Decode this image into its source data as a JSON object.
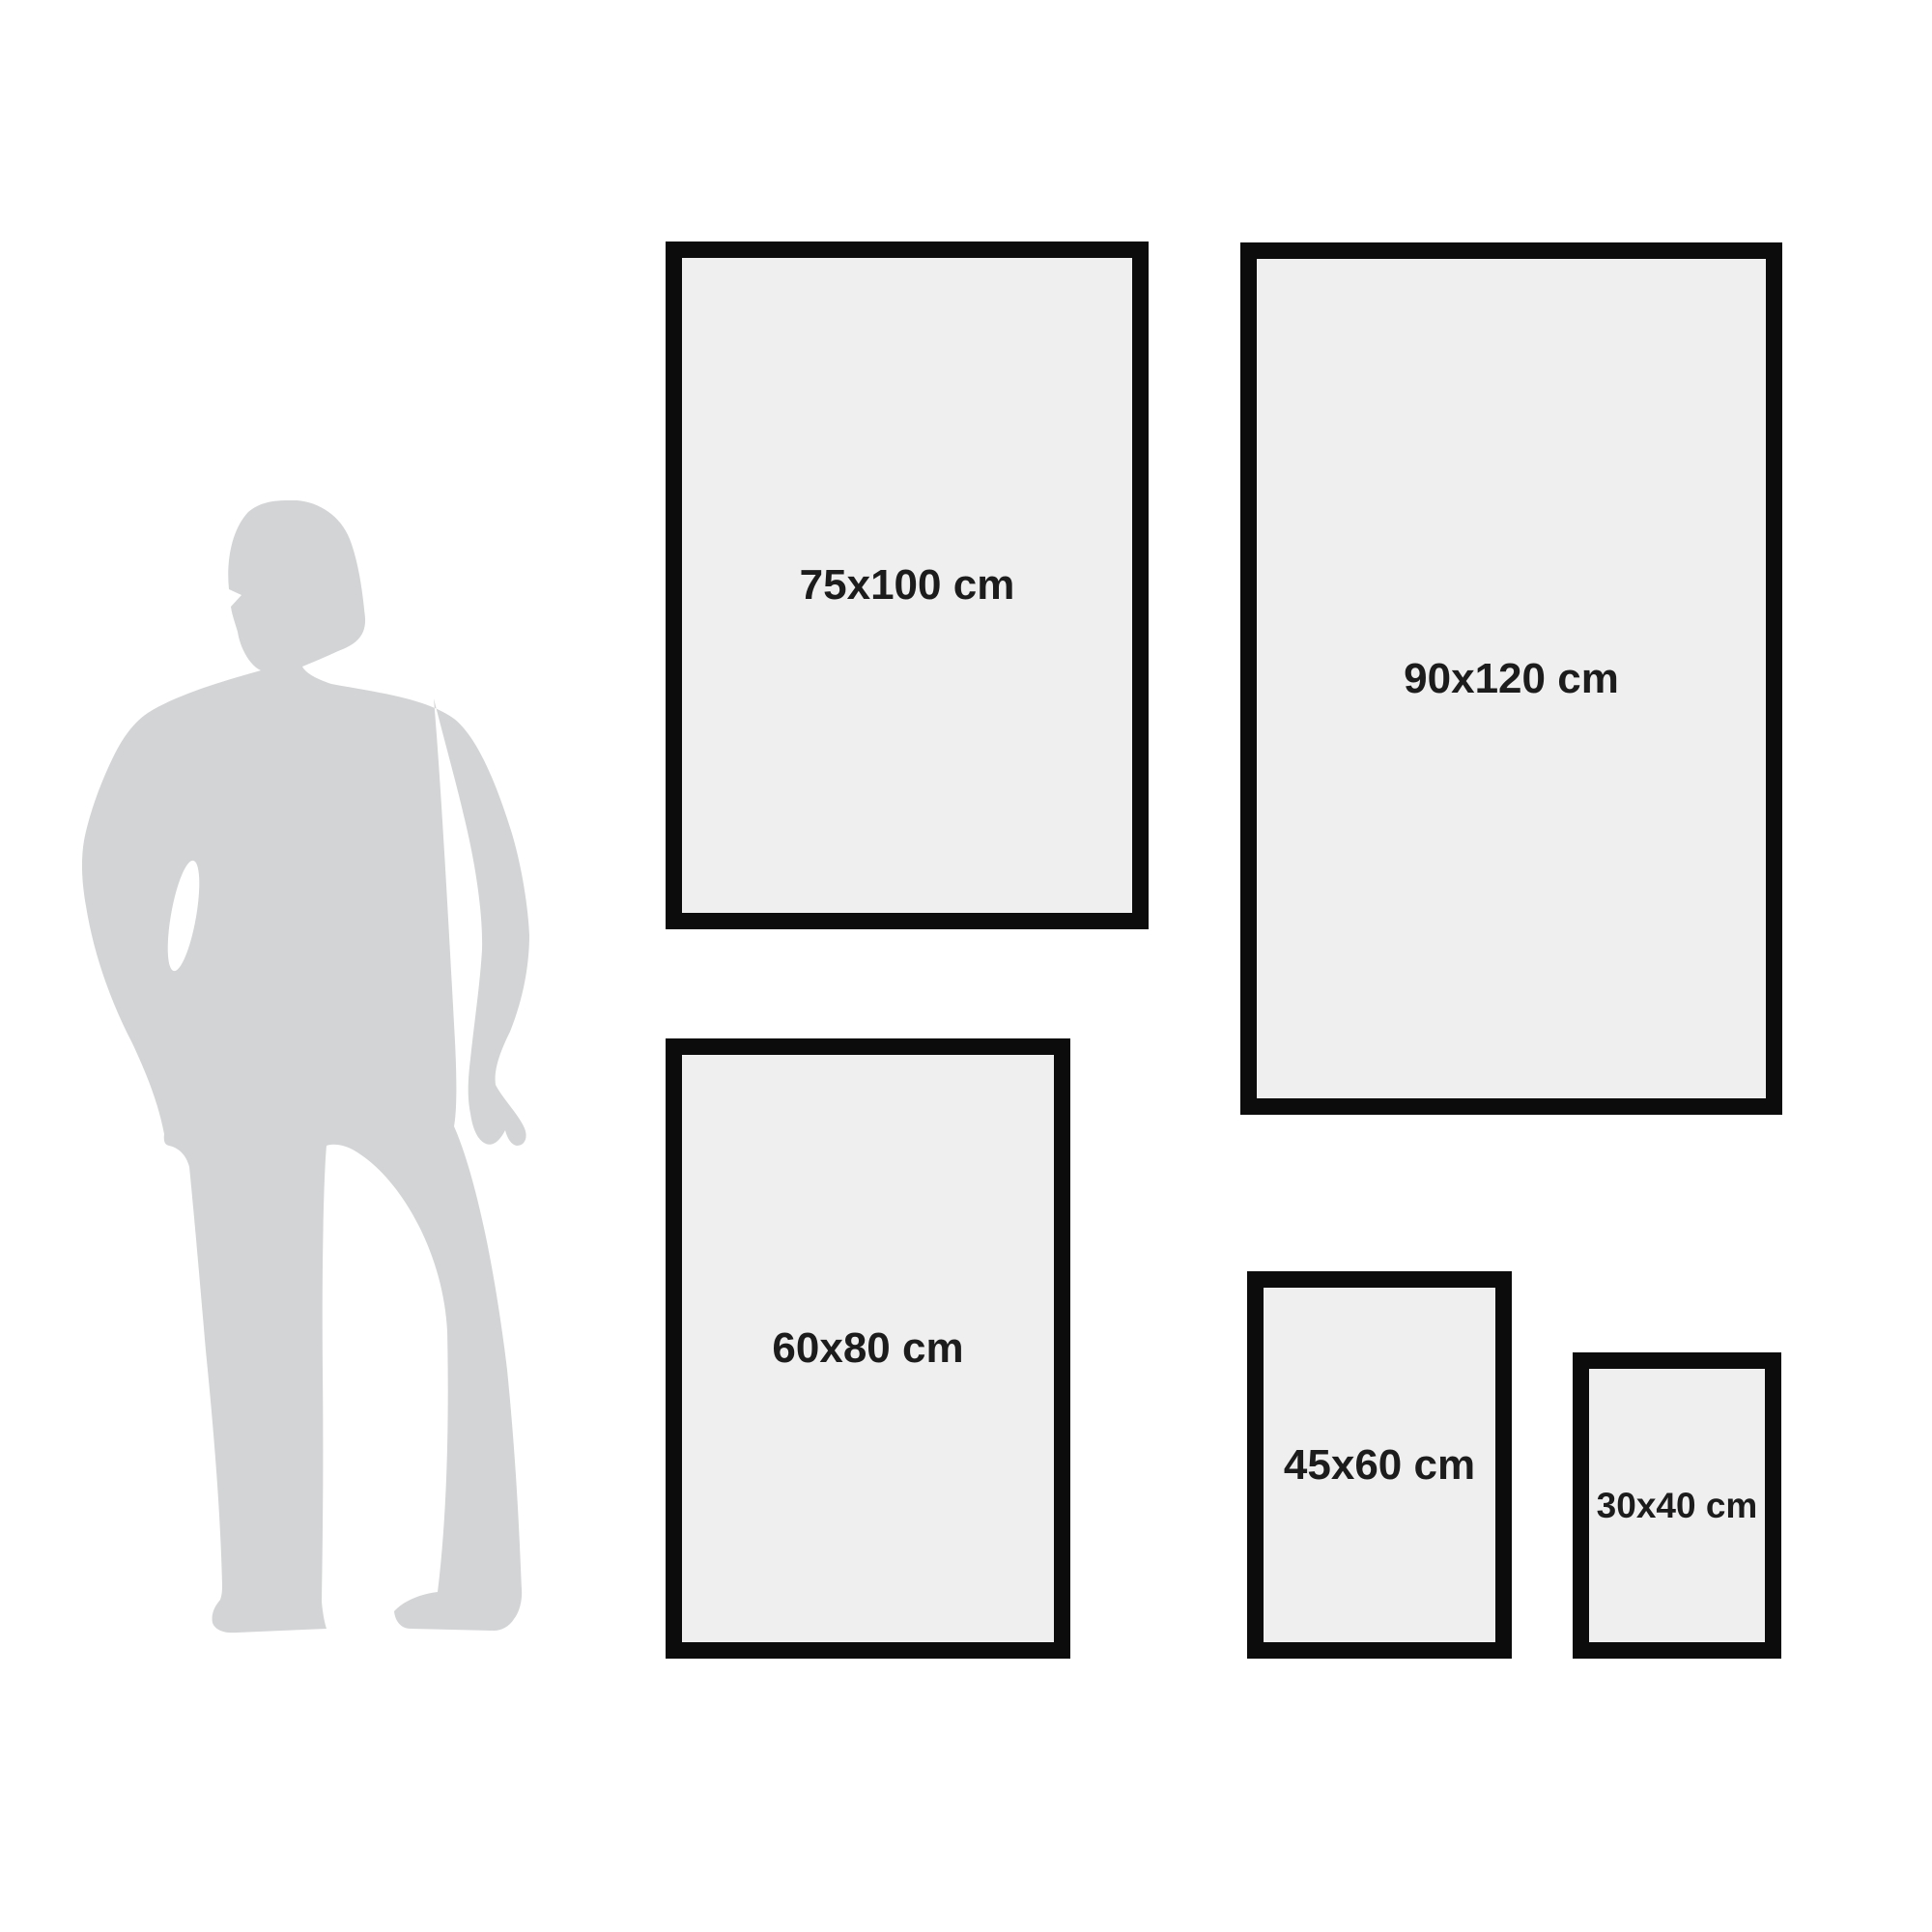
{
  "colors": {
    "background": "#ffffff",
    "silhouette": "#d3d4d6",
    "frame_border": "#0c0c0c",
    "frame_fill": "#f0efef",
    "label_text": "#1c1c1c"
  },
  "figure": {
    "name": "standing-man-silhouette",
    "purpose": "human height reference for poster sizes"
  },
  "frames": [
    {
      "id": "frame-75x100",
      "label": "75x100 cm",
      "width_cm": 75,
      "height_cm": 100
    },
    {
      "id": "frame-90x120",
      "label": "90x120 cm",
      "width_cm": 90,
      "height_cm": 120
    },
    {
      "id": "frame-60x80",
      "label": "60x80 cm",
      "width_cm": 60,
      "height_cm": 80
    },
    {
      "id": "frame-45x60",
      "label": "45x60 cm",
      "width_cm": 45,
      "height_cm": 60
    },
    {
      "id": "frame-30x40",
      "label": "30x40 cm",
      "width_cm": 30,
      "height_cm": 40
    }
  ]
}
